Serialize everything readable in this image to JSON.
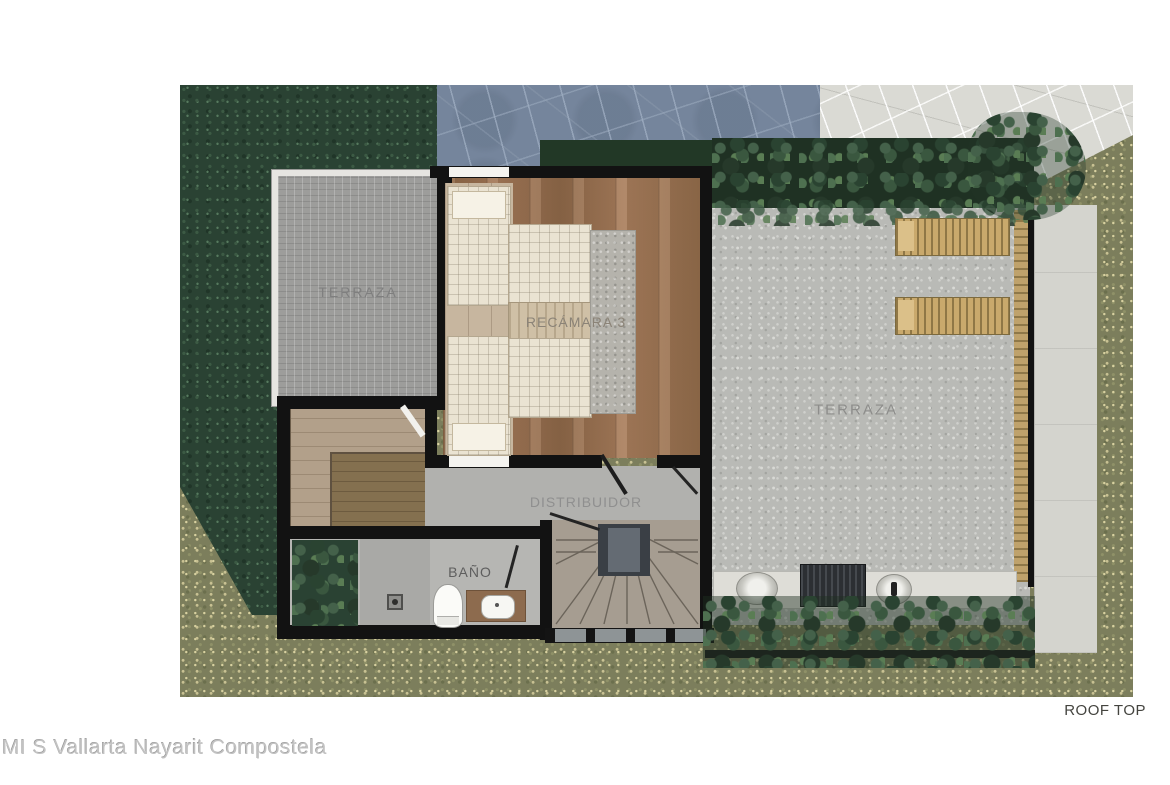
{
  "plan": {
    "title": "ROOF TOP",
    "type": "architectural-floor-plan",
    "level": "roof top"
  },
  "watermark": {
    "text": "MI S Vallarta Nayarit Compostela"
  },
  "rooms": {
    "terraza_left": {
      "label": "TERRAZA"
    },
    "recamara_3": {
      "label": "RECÁMARA 3"
    },
    "terraza_right": {
      "label": "TERRAZA"
    },
    "distribuidor": {
      "label": "DISTRIBUIDOR"
    },
    "bano": {
      "label": "BAÑO"
    }
  },
  "features": {
    "loungers_count": 2,
    "single_beds_count": 2,
    "staircase": "fan-winder-staircase",
    "fixtures": [
      "toilet",
      "vanity-sink",
      "shower-drain",
      "grill",
      "planters",
      "lawn",
      "pool-deck-flagstone"
    ]
  },
  "colors": {
    "background": "#ffffff",
    "grass": "#7c7e5c",
    "dark_foliage": "#2a4233",
    "blue_flagstone": "#75859c",
    "pale_flagstone": "#dadad4",
    "tile_gray": "#9d9d9b",
    "terrazzo": "#b9bab6",
    "wood_floor": "#97704f",
    "wall_black": "#121212",
    "bed_linen": "#eae3d2",
    "lounger_wood": "#c9a96c",
    "room_label_gray": "#8c8c8c",
    "title_gray": "#44443f",
    "watermark_gray": "#c2c2c2"
  }
}
